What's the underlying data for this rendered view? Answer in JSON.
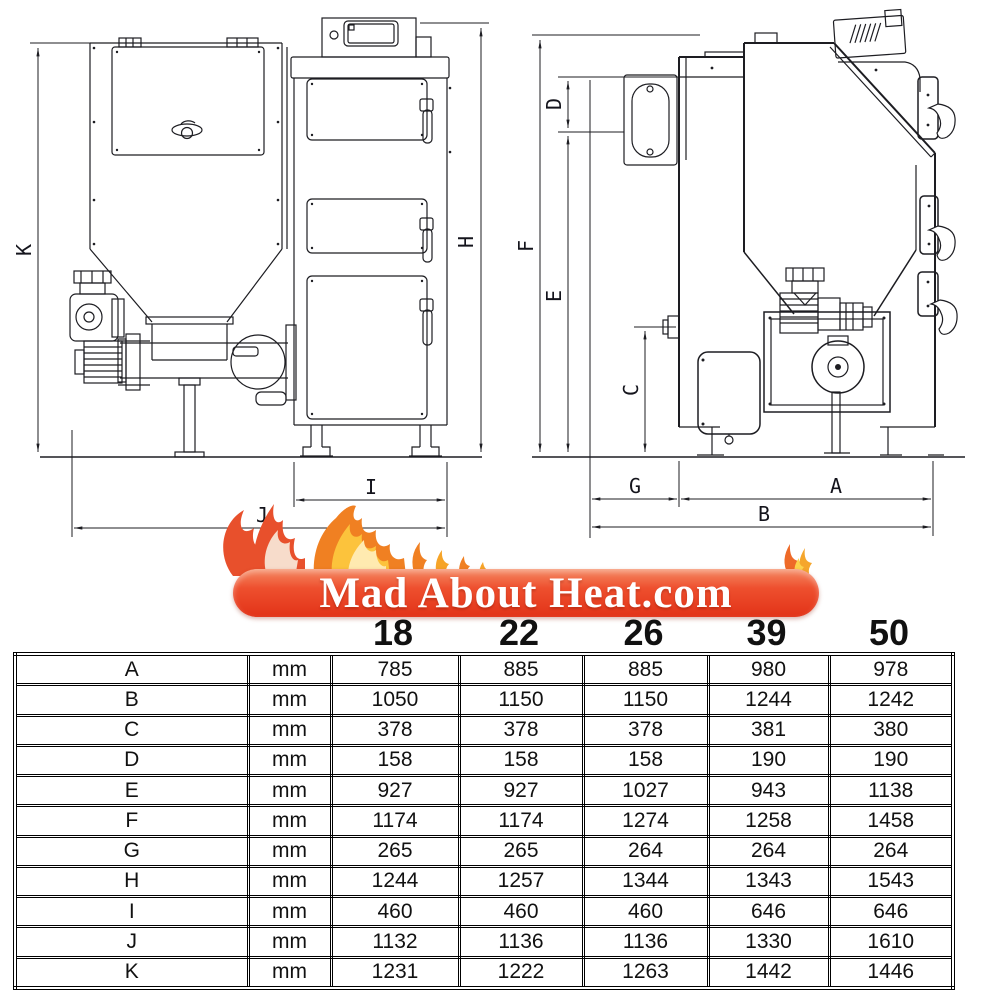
{
  "logo": {
    "text": "Mad About Heat.com",
    "banner_color_top": "#f58a63",
    "banner_color_bottom": "#e23318",
    "text_color": "#ffffff",
    "flame_colors": [
      "#e8502c",
      "#f08022",
      "#fcc33c",
      "#ffeab0",
      "#f7dccb"
    ]
  },
  "drawings": {
    "front_view_name": "boiler with hopper - front view",
    "side_view_name": "boiler with hopper - side view",
    "dims": {
      "A": "A",
      "B": "B",
      "C": "C",
      "D": "D",
      "E": "E",
      "F": "F",
      "G": "G",
      "H": "H",
      "I": "I",
      "J": "J",
      "K": "K"
    }
  },
  "table": {
    "models": [
      "18",
      "22",
      "26",
      "39",
      "50"
    ],
    "rows": [
      {
        "label": "A",
        "unit": "mm",
        "values": [
          "785",
          "885",
          "885",
          "980",
          "978"
        ]
      },
      {
        "label": "B",
        "unit": "mm",
        "values": [
          "1050",
          "1150",
          "1150",
          "1244",
          "1242"
        ]
      },
      {
        "label": "C",
        "unit": "mm",
        "values": [
          "378",
          "378",
          "378",
          "381",
          "380"
        ]
      },
      {
        "label": "D",
        "unit": "mm",
        "values": [
          "158",
          "158",
          "158",
          "190",
          "190"
        ]
      },
      {
        "label": "E",
        "unit": "mm",
        "values": [
          "927",
          "927",
          "1027",
          "943",
          "1138"
        ]
      },
      {
        "label": "F",
        "unit": "mm",
        "values": [
          "1174",
          "1174",
          "1274",
          "1258",
          "1458"
        ]
      },
      {
        "label": "G",
        "unit": "mm",
        "values": [
          "265",
          "265",
          "264",
          "264",
          "264"
        ]
      },
      {
        "label": "H",
        "unit": "mm",
        "values": [
          "1244",
          "1257",
          "1344",
          "1343",
          "1543"
        ]
      },
      {
        "label": "I",
        "unit": "mm",
        "values": [
          "460",
          "460",
          "460",
          "646",
          "646"
        ]
      },
      {
        "label": "J",
        "unit": "mm",
        "values": [
          "1132",
          "1136",
          "1136",
          "1330",
          "1610"
        ]
      },
      {
        "label": "K",
        "unit": "mm",
        "values": [
          "1231",
          "1222",
          "1263",
          "1442",
          "1446"
        ]
      }
    ]
  }
}
